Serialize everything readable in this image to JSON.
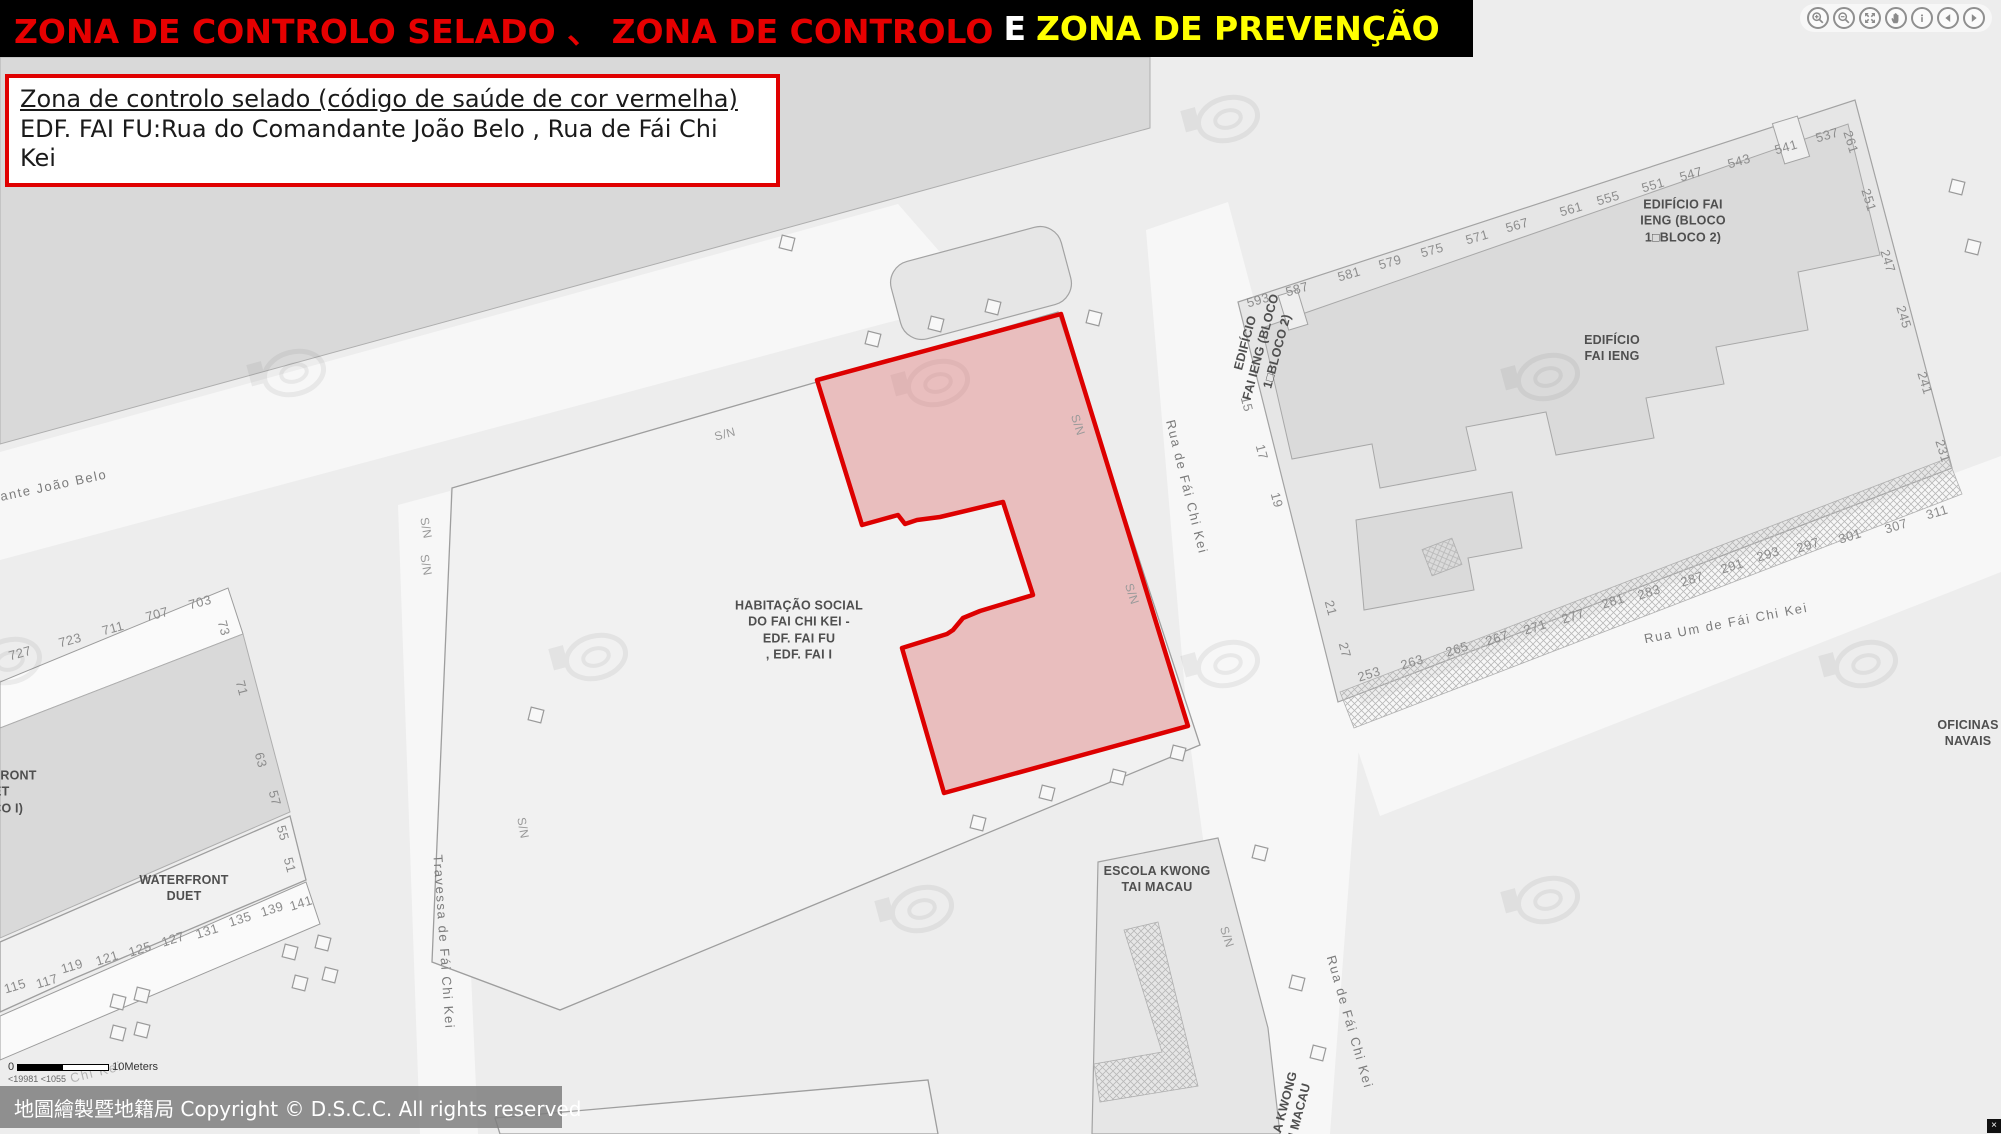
{
  "header": {
    "segment_red": "ZONA DE CONTROLO SELADO 、 ZONA DE CONTROLO",
    "segment_and": "E",
    "segment_yellow": "ZONA DE PREVENÇÃO"
  },
  "toolbar_icons": [
    "zoom-in",
    "zoom-out",
    "zoom-extent",
    "pan",
    "identify",
    "previous-view",
    "next-view"
  ],
  "info_box": {
    "title": "Zona de controlo selado (código de saúde de cor vermelha)",
    "body": "EDF. FAI FU:Rua do Comandante João Belo , Rua de Fái Chi Kei"
  },
  "sealed_zone": {
    "polygon_points": "1061,314 817,380 862,525 898,515 905,524 917,520 940,517 1003,502 1033,595 980,611 963,618 953,630 947,634 902,648 944,793 1188,726",
    "fill": "rgba(219,88,88,0.33)",
    "stroke": "#dd0000"
  },
  "map": {
    "sn_text": "S/N",
    "building_labels": [
      {
        "name": "habitacao-social-label",
        "text": "HABITAÇÃO SOCIAL\nDO FAI CHI KEI -\nEDF. FAI FU\n, EDF. FAI I",
        "x": 799,
        "y": 630,
        "rot": 0
      },
      {
        "name": "edificio-fai-ieng-bloco-label",
        "text": "EDIFÍCIO FAI\nIENG (BLOCO\n1□BLOCO 2)",
        "x": 1683,
        "y": 221,
        "rot": 0
      },
      {
        "name": "edificio-fai-ieng-label",
        "text": "EDIFÍCIO\nFAI IENG",
        "x": 1612,
        "y": 348,
        "rot": 0
      },
      {
        "name": "edificio-fai-ieng-vertical-label",
        "text": "EDIFÍCIO\nFAI IENG (BLOCO\n1□BLOCO 2)",
        "x": 1261,
        "y": 347,
        "rot": -75
      },
      {
        "name": "escola-kwong-tai-label",
        "text": "ESCOLA KWONG\nTAI MACAU",
        "x": 1157,
        "y": 879,
        "rot": 0
      },
      {
        "name": "waterfront-duet-label",
        "text": "WATERFRONT\nDUET",
        "x": 184,
        "y": 888,
        "rot": 0
      },
      {
        "name": "waterfront-duet-bloco-label",
        "text": "WATERFRONT\nDUET\n(BLOCO I)",
        "x": -8,
        "y": 792,
        "rot": 0
      },
      {
        "name": "oficinas-navais-label",
        "text": "OFICINAS\nNAVAIS",
        "x": 1968,
        "y": 733,
        "rot": 0
      },
      {
        "name": "escola-kwong-tai-vertical-label",
        "text": "LA KWONG\nI MACAU",
        "x": 1292,
        "y": 1108,
        "rot": -75
      }
    ],
    "street_labels": [
      {
        "text": "ndante João Belo",
        "x": 45,
        "y": 487,
        "rot": -12
      },
      {
        "text": "Rua de Fái Chi Kei",
        "x": 1187,
        "y": 487,
        "rot": 76
      },
      {
        "text": "Rua de Fái Chi Kei",
        "x": 1350,
        "y": 1022,
        "rot": 74
      },
      {
        "text": "Rua Um de Fái Chi Kei",
        "x": 1726,
        "y": 623,
        "rot": -11
      },
      {
        "text": "Travessa de Fái Chi Kei",
        "x": 444,
        "y": 942,
        "rot": 86
      },
      {
        "text": "Chi Kei",
        "x": 96,
        "y": 1072,
        "rot": -14,
        "faint": true
      }
    ],
    "sn_labels": [
      {
        "x": 725,
        "y": 434,
        "rot": -15
      },
      {
        "x": 426,
        "y": 528,
        "rot": 80
      },
      {
        "x": 426,
        "y": 565,
        "rot": 80
      },
      {
        "x": 523,
        "y": 828,
        "rot": 80
      },
      {
        "x": 1078,
        "y": 425,
        "rot": 72
      },
      {
        "x": 1132,
        "y": 594,
        "rot": 72
      },
      {
        "x": 1227,
        "y": 937,
        "rot": 72
      }
    ],
    "numbers": [
      {
        "v": "593",
        "x": 1258,
        "y": 300,
        "r": -16
      },
      {
        "v": "587",
        "x": 1297,
        "y": 289,
        "r": -16
      },
      {
        "v": "581",
        "x": 1349,
        "y": 274,
        "r": -16
      },
      {
        "v": "579",
        "x": 1390,
        "y": 262,
        "r": -16
      },
      {
        "v": "575",
        "x": 1432,
        "y": 250,
        "r": -16
      },
      {
        "v": "571",
        "x": 1477,
        "y": 237,
        "r": -16
      },
      {
        "v": "567",
        "x": 1517,
        "y": 225,
        "r": -16
      },
      {
        "v": "561",
        "x": 1571,
        "y": 209,
        "r": -16
      },
      {
        "v": "555",
        "x": 1608,
        "y": 198,
        "r": -16
      },
      {
        "v": "551",
        "x": 1653,
        "y": 185,
        "r": -16
      },
      {
        "v": "547",
        "x": 1691,
        "y": 174,
        "r": -16
      },
      {
        "v": "543",
        "x": 1739,
        "y": 161,
        "r": -16
      },
      {
        "v": "541",
        "x": 1786,
        "y": 147,
        "r": -16
      },
      {
        "v": "537",
        "x": 1827,
        "y": 135,
        "r": -16
      },
      {
        "v": "261",
        "x": 1851,
        "y": 142,
        "r": 73
      },
      {
        "v": "251",
        "x": 1869,
        "y": 200,
        "r": 73
      },
      {
        "v": "247",
        "x": 1888,
        "y": 261,
        "r": 73
      },
      {
        "v": "245",
        "x": 1904,
        "y": 317,
        "r": 73
      },
      {
        "v": "241",
        "x": 1925,
        "y": 383,
        "r": 73
      },
      {
        "v": "231",
        "x": 1943,
        "y": 451,
        "r": 73
      },
      {
        "v": "15",
        "x": 1247,
        "y": 404,
        "r": 75
      },
      {
        "v": "17",
        "x": 1262,
        "y": 452,
        "r": 75
      },
      {
        "v": "19",
        "x": 1277,
        "y": 500,
        "r": 75
      },
      {
        "v": "21",
        "x": 1331,
        "y": 608,
        "r": 75
      },
      {
        "v": "27",
        "x": 1345,
        "y": 650,
        "r": 75
      },
      {
        "v": "253",
        "x": 1369,
        "y": 674,
        "r": -17
      },
      {
        "v": "263",
        "x": 1412,
        "y": 662,
        "r": -17
      },
      {
        "v": "265",
        "x": 1457,
        "y": 649,
        "r": -17
      },
      {
        "v": "267",
        "x": 1497,
        "y": 638,
        "r": -17
      },
      {
        "v": "271",
        "x": 1535,
        "y": 627,
        "r": -17
      },
      {
        "v": "277",
        "x": 1573,
        "y": 616,
        "r": -17
      },
      {
        "v": "281",
        "x": 1613,
        "y": 601,
        "r": -17
      },
      {
        "v": "283",
        "x": 1649,
        "y": 592,
        "r": -17
      },
      {
        "v": "287",
        "x": 1692,
        "y": 579,
        "r": -17
      },
      {
        "v": "291",
        "x": 1732,
        "y": 566,
        "r": -17
      },
      {
        "v": "293",
        "x": 1768,
        "y": 554,
        "r": -17
      },
      {
        "v": "297",
        "x": 1808,
        "y": 545,
        "r": -17
      },
      {
        "v": "301",
        "x": 1850,
        "y": 536,
        "r": -17
      },
      {
        "v": "307",
        "x": 1896,
        "y": 526,
        "r": -17
      },
      {
        "v": "311",
        "x": 1937,
        "y": 512,
        "r": -17
      },
      {
        "v": "727",
        "x": 20,
        "y": 653,
        "r": -15
      },
      {
        "v": "723",
        "x": 70,
        "y": 640,
        "r": -15
      },
      {
        "v": "711",
        "x": 113,
        "y": 628,
        "r": -15
      },
      {
        "v": "707",
        "x": 157,
        "y": 614,
        "r": -15
      },
      {
        "v": "703",
        "x": 200,
        "y": 602,
        "r": -15
      },
      {
        "v": "73",
        "x": 224,
        "y": 628,
        "r": 75
      },
      {
        "v": "71",
        "x": 242,
        "y": 688,
        "r": 75
      },
      {
        "v": "63",
        "x": 261,
        "y": 760,
        "r": 75
      },
      {
        "v": "57",
        "x": 275,
        "y": 798,
        "r": 75
      },
      {
        "v": "55",
        "x": 283,
        "y": 833,
        "r": 75
      },
      {
        "v": "51",
        "x": 290,
        "y": 865,
        "r": 75
      },
      {
        "v": "115",
        "x": 15,
        "y": 986,
        "r": -17
      },
      {
        "v": "117",
        "x": 47,
        "y": 981,
        "r": -17
      },
      {
        "v": "119",
        "x": 72,
        "y": 966,
        "r": -17
      },
      {
        "v": "121",
        "x": 107,
        "y": 958,
        "r": -17
      },
      {
        "v": "125",
        "x": 140,
        "y": 949,
        "r": -17
      },
      {
        "v": "127",
        "x": 173,
        "y": 939,
        "r": -17
      },
      {
        "v": "131",
        "x": 207,
        "y": 931,
        "r": -17
      },
      {
        "v": "135",
        "x": 240,
        "y": 919,
        "r": -17
      },
      {
        "v": "139",
        "x": 272,
        "y": 909,
        "r": -17
      },
      {
        "v": "141",
        "x": 301,
        "y": 903,
        "r": -17
      }
    ],
    "trees": [
      [
        873,
        339
      ],
      [
        936,
        324
      ],
      [
        993,
        307
      ],
      [
        1094,
        318
      ],
      [
        787,
        243
      ],
      [
        1178,
        753
      ],
      [
        1118,
        777
      ],
      [
        1047,
        793
      ],
      [
        978,
        823
      ],
      [
        1260,
        853
      ],
      [
        1297,
        983
      ],
      [
        1318,
        1053
      ],
      [
        118,
        1002
      ],
      [
        142,
        995
      ],
      [
        118,
        1033
      ],
      [
        142,
        1030
      ],
      [
        290,
        952
      ],
      [
        323,
        943
      ],
      [
        300,
        983
      ],
      [
        330,
        975
      ],
      [
        536,
        715
      ],
      [
        1957,
        187
      ],
      [
        1973,
        247
      ]
    ],
    "watermarks": [
      [
        294,
        373
      ],
      [
        938,
        383
      ],
      [
        1228,
        119
      ],
      [
        1548,
        377
      ],
      [
        596,
        657
      ],
      [
        10,
        661
      ],
      [
        922,
        909
      ],
      [
        1548,
        900
      ],
      [
        1866,
        664
      ],
      [
        1228,
        664
      ]
    ]
  },
  "scale_bar": {
    "zero": "0",
    "distance": "10Meters",
    "sub_text": "<19981 <1055"
  },
  "copyright": "地圖繪製暨地籍局 Copyright © D.S.C.C. All rights reserved",
  "corner": {
    "glyph": "×"
  }
}
